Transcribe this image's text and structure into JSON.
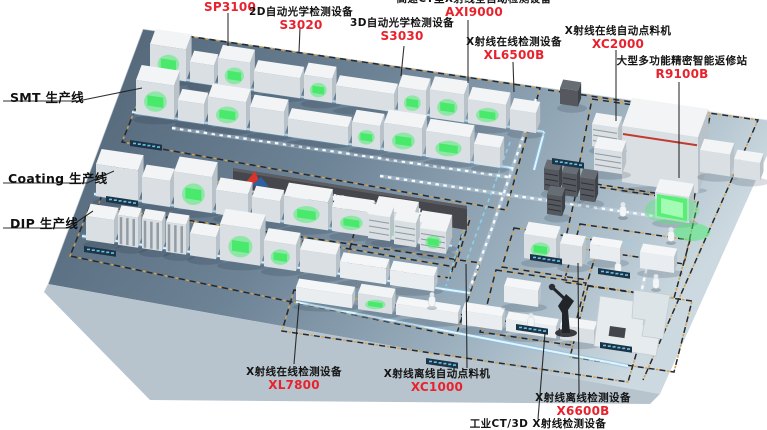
{
  "banner": {
    "company_name": "卓茂科技"
  },
  "production_line_labels": [
    {
      "label": "SMT 生产线"
    },
    {
      "label": "Coating 生产线"
    },
    {
      "label": "DIP 生产线"
    }
  ],
  "equipment_labels_top": [
    {
      "name": "",
      "model": "SP3100"
    },
    {
      "name": "2D自动光学检测设备",
      "model": "S3020"
    },
    {
      "name": "3D自动光学检测设备",
      "model": "S3030"
    },
    {
      "name": "高速CT型X射线全自动检测设备",
      "model": "AXI9000"
    },
    {
      "name": "X射线在线检测设备",
      "model": "XL6500B"
    },
    {
      "name": "X射线在线自动点料机",
      "model": "XC2000"
    },
    {
      "name": "大型多功能精密智能返修站",
      "model": "R9100B"
    }
  ],
  "equipment_labels_bottom": [
    {
      "name": "X射线在线检测设备",
      "model": "XL7800"
    },
    {
      "name": "X射线离线自动点料机",
      "model": "XC1000"
    },
    {
      "name": "X射线离线检测设备",
      "model": "X6600B"
    },
    {
      "name": "工业CT/3D X射线检测设备",
      "model": ""
    }
  ],
  "colors": {
    "model_red": "#e8222d",
    "label_black": "#141414",
    "platform_dark": "#4e6173",
    "platform_light": "#ccd9e0",
    "banner_bg": "#46474c",
    "glow_green": "#46e86a",
    "conveyor_blue": "#bfeaff",
    "zone_dash_black": "#26292d",
    "zone_dash_yellow": "#dfa03c"
  }
}
